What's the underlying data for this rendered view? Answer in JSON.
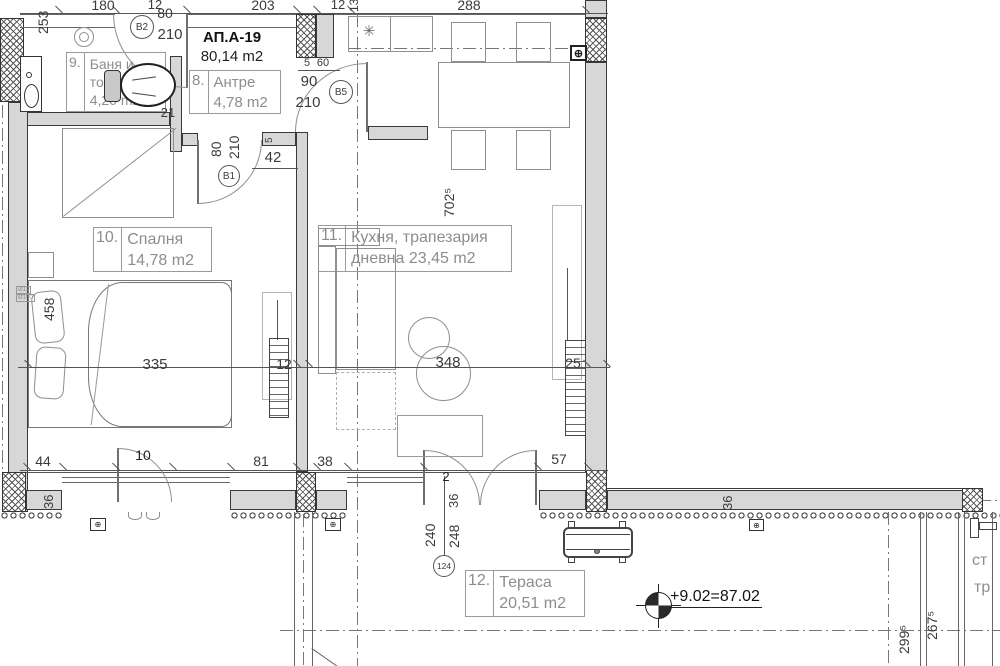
{
  "title": {
    "id": "АП.А-19",
    "area": "80,14 m2"
  },
  "rooms": {
    "bath": {
      "num": "9.",
      "line1": "Баня и",
      "line2": "тоалетна",
      "area": "4,20 m2"
    },
    "hall": {
      "num": "8.",
      "line1": "Антре",
      "area": "4,78 m2"
    },
    "bedroom": {
      "num": "10.",
      "line1": "Спалня",
      "area": "14,78 m2"
    },
    "kitchen": {
      "num": "11.",
      "line1": "Кухня, трапезария",
      "line2": "дневна",
      "area": "23,45 m2"
    },
    "terrace": {
      "num": "12.",
      "line1": "Тераса",
      "area": "20,51 m2"
    }
  },
  "doors": {
    "b1": "В1",
    "b2": "В2",
    "b5": "В5",
    "w124": "124"
  },
  "dims": {
    "t180": "180",
    "t12": "12",
    "t80": "80",
    "t203": "203",
    "t12b": "12",
    "t288": "288",
    "b2h": "210",
    "b1w": "80",
    "b1h": "210",
    "b5w": "90",
    "b5h": "210",
    "s5": "5",
    "s60": "60",
    "s5b": "5",
    "s21": "21",
    "s42": "42",
    "m335": "335",
    "m12": "12",
    "m348": "348",
    "m25": "25",
    "v253": "253",
    "v132": "132",
    "v458": "458",
    "v702": "702⁵",
    "b44": "44",
    "b10": "10",
    "b81": "81",
    "b38": "38",
    "b57": "57",
    "b2s": "2",
    "v36a": "36",
    "v36b": "36",
    "v36c": "36",
    "v240": "240",
    "v248": "248",
    "v299": "299⁵",
    "v267": "267⁵"
  },
  "elevation": {
    "text": "+9.02=87.02"
  },
  "partial": {
    "t1": "ст",
    "t2": "тр"
  },
  "micro": {
    "m1": "Ø12",
    "m2": "Ø160"
  },
  "symbols": {
    "panel": "⊕",
    "hob": "✳"
  }
}
